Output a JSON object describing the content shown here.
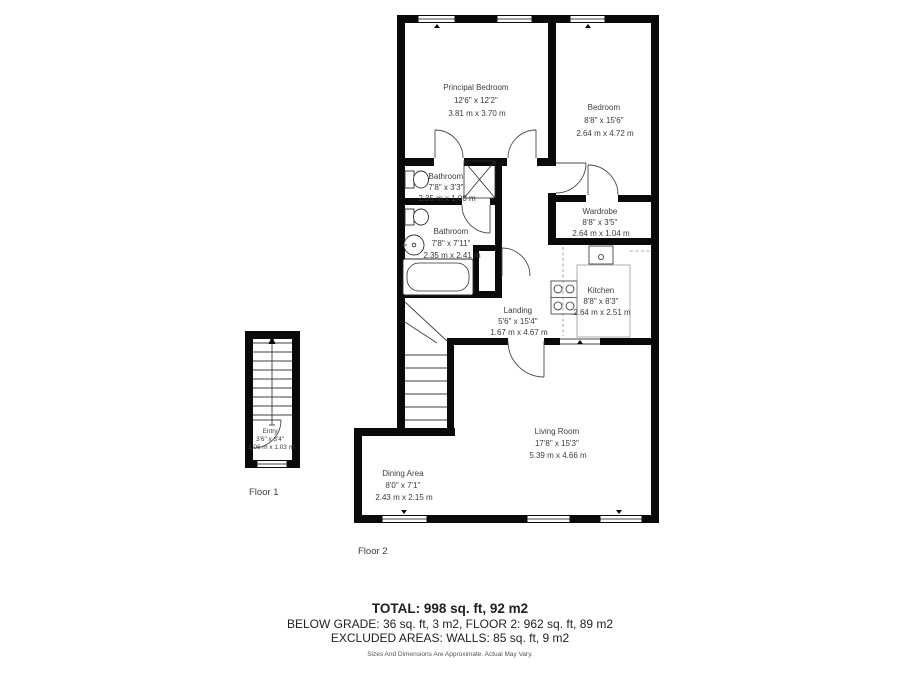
{
  "rooms": {
    "principal_bedroom": {
      "name": "Principal Bedroom",
      "imperial": "12'6\" x 12'2\"",
      "metric": "3.81 m x 3.70 m"
    },
    "bedroom": {
      "name": "Bedroom",
      "imperial": "8'8\" x 15'6\"",
      "metric": "2.64 m x 4.72 m"
    },
    "bathroom_small": {
      "name": "Bathroom",
      "imperial": "7'8\" x 3'3\"",
      "metric": "2.35 m x 1.00 m"
    },
    "bathroom_main": {
      "name": "Bathroom",
      "imperial": "7'8\" x 7'11\"",
      "metric": "2.35 m x 2.41 m"
    },
    "wardrobe": {
      "name": "Wardrobe",
      "imperial": "8'8\" x 3'5\"",
      "metric": "2.64 m x 1.04 m"
    },
    "kitchen": {
      "name": "Kitchen",
      "imperial": "8'8\" x 8'3\"",
      "metric": "2.64 m x 2.51 m"
    },
    "landing": {
      "name": "Landing",
      "imperial": "5'6\" x 15'4\"",
      "metric": "1.67 m x 4.67 m"
    },
    "living_room": {
      "name": "Living Room",
      "imperial": "17'8\" x 15'3\"",
      "metric": "5.39 m x 4.66 m"
    },
    "dining_area": {
      "name": "Dining Area",
      "imperial": "8'0\" x 7'1\"",
      "metric": "2.43 m x 2.15 m"
    },
    "entry": {
      "name": "Entry",
      "imperial": "3'6\" x 3'4\"",
      "metric": "1.06 m x 1.03 m"
    }
  },
  "floor_labels": {
    "floor1": "Floor 1",
    "floor2": "Floor 2"
  },
  "summary": {
    "total": "TOTAL: 998 sq. ft, 92 m2",
    "breakdown": "BELOW GRADE: 36 sq. ft, 3 m2, FLOOR 2: 962 sq. ft, 89 m2",
    "excluded": "EXCLUDED AREAS: WALLS: 85 sq. ft, 9 m2",
    "disclaimer": "Sizes And Dimensions Are Approximate. Actual May Vary."
  },
  "colors": {
    "wall": "#0a0a0a",
    "label_text": "#3c3c3c",
    "summary_text": "#1f1f1f",
    "disclaimer_text": "#555555"
  }
}
